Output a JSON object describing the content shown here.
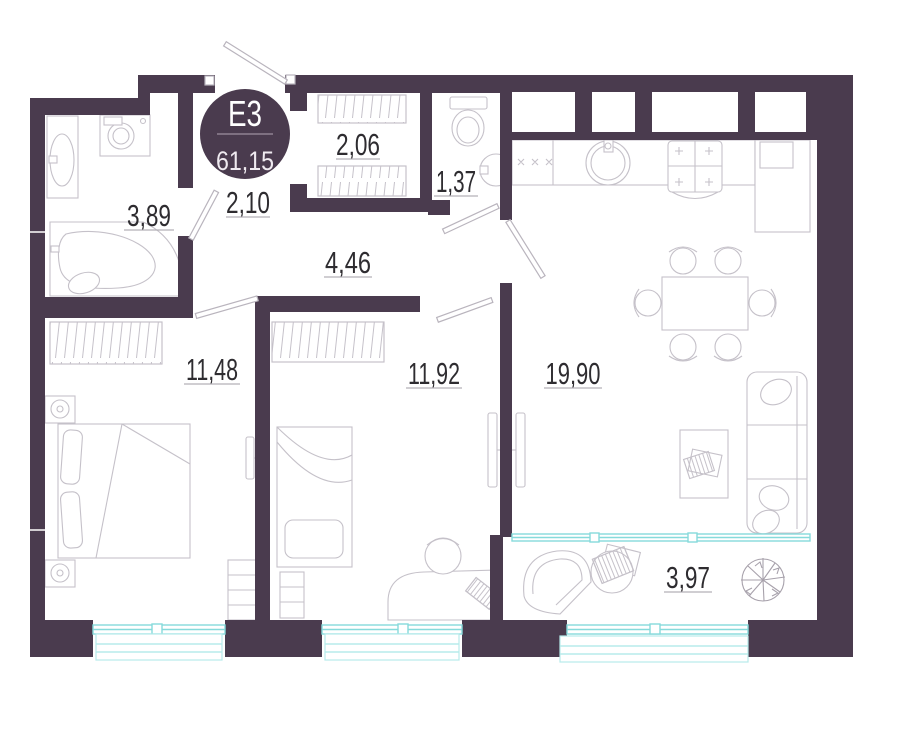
{
  "plan": {
    "badge": {
      "code": "E3",
      "total_area": "61,15"
    },
    "rooms": [
      {
        "id": "bathroom",
        "area": "3,89"
      },
      {
        "id": "hall",
        "area": "2,10"
      },
      {
        "id": "closet",
        "area": "2,06"
      },
      {
        "id": "wc",
        "area": "1,37"
      },
      {
        "id": "corridor",
        "area": "4,46"
      },
      {
        "id": "bedroom-1",
        "area": "11,48"
      },
      {
        "id": "bedroom-2",
        "area": "11,92"
      },
      {
        "id": "kitchen-living",
        "area": "19,90"
      },
      {
        "id": "balcony",
        "area": "3,97"
      }
    ],
    "colors": {
      "wall": "#4a3b4e",
      "window": "#86dadb",
      "furniture": "#c5c1c9",
      "label": "#2e2c30"
    }
  }
}
